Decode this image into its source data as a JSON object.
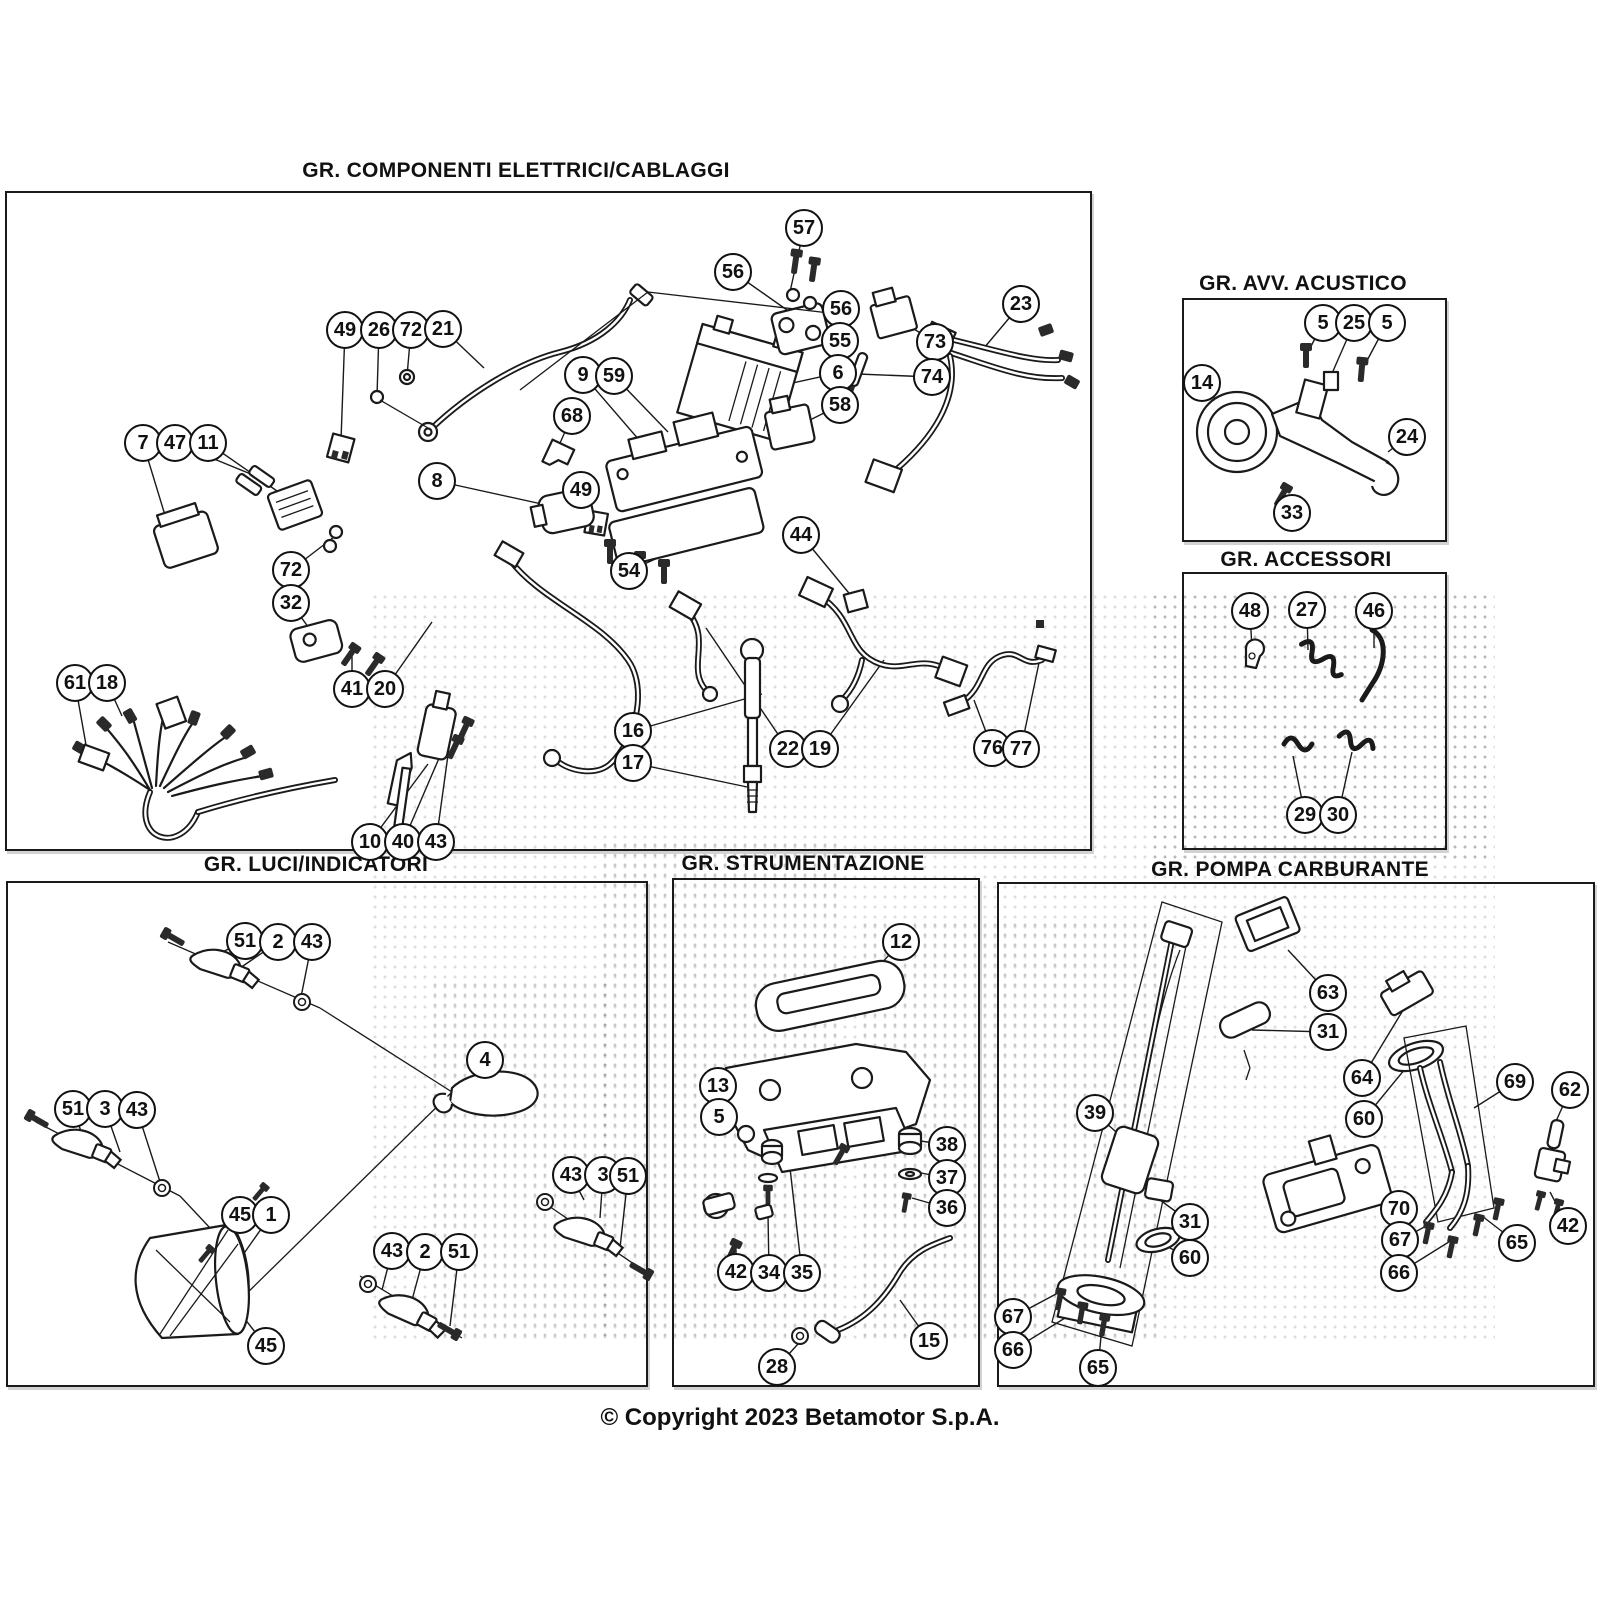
{
  "page": {
    "copyright": "© Copyright 2023 Betamotor S.p.A.",
    "background": "#ffffff",
    "line_color": "#1a1a1a",
    "canvas": {
      "w": 1600,
      "h": 1600
    }
  },
  "sections": [
    {
      "id": "elettrici",
      "title": "GR. COMPONENTI ELETTRICI/CABLAGGI",
      "title_pos": {
        "x": 516,
        "y": 172
      },
      "box": {
        "x": 5,
        "y": 191,
        "w": 1087,
        "h": 660
      },
      "callouts": [
        {
          "n": "57",
          "x": 804,
          "y": 228,
          "t": [
            790,
            292
          ]
        },
        {
          "n": "56",
          "x": 733,
          "y": 272,
          "t": [
            787,
            310
          ]
        },
        {
          "n": "56",
          "x": 841,
          "y": 309,
          "t": [
            806,
            324
          ]
        },
        {
          "n": "55",
          "x": 840,
          "y": 341,
          "t": [
            800,
            340
          ]
        },
        {
          "n": "73",
          "x": 935,
          "y": 342,
          "t": [
            896,
            318
          ]
        },
        {
          "n": "6",
          "x": 838,
          "y": 373,
          "t": [
            788,
            384
          ]
        },
        {
          "n": "74",
          "x": 932,
          "y": 377,
          "t": [
            858,
            374
          ]
        },
        {
          "n": "58",
          "x": 840,
          "y": 405,
          "t": [
            802,
            424
          ]
        },
        {
          "n": "23",
          "x": 1021,
          "y": 304,
          "t": [
            984,
            348
          ]
        },
        {
          "n": "49",
          "x": 345,
          "y": 330,
          "t": [
            341,
            440
          ]
        },
        {
          "n": "26",
          "x": 379,
          "y": 330,
          "t": [
            377,
            396
          ]
        },
        {
          "n": "72",
          "x": 411,
          "y": 330,
          "t": [
            407,
            376
          ]
        },
        {
          "n": "21",
          "x": 443,
          "y": 329,
          "t": [
            484,
            368
          ]
        },
        {
          "n": "9",
          "x": 583,
          "y": 375,
          "t": [
            646,
            448
          ]
        },
        {
          "n": "59",
          "x": 614,
          "y": 376,
          "t": [
            668,
            432
          ]
        },
        {
          "n": "68",
          "x": 572,
          "y": 416,
          "t": [
            556,
            452
          ]
        },
        {
          "n": "7",
          "x": 143,
          "y": 443,
          "t": [
            168,
            525
          ]
        },
        {
          "n": "47",
          "x": 175,
          "y": 443,
          "t": [
            258,
            477
          ]
        },
        {
          "n": "11",
          "x": 208,
          "y": 443,
          "t": [
            290,
            500
          ]
        },
        {
          "n": "8",
          "x": 437,
          "y": 481,
          "t": [
            560,
            508
          ]
        },
        {
          "n": "49",
          "x": 581,
          "y": 490,
          "t": [
            594,
            522
          ]
        },
        {
          "n": "44",
          "x": 801,
          "y": 535,
          "t": [
            853,
            598
          ]
        },
        {
          "n": "54",
          "x": 629,
          "y": 571,
          "t": [
            662,
            556
          ]
        },
        {
          "n": "72",
          "x": 291,
          "y": 570,
          "t": [
            334,
            537
          ]
        },
        {
          "n": "32",
          "x": 291,
          "y": 603,
          "t": [
            316,
            638
          ]
        },
        {
          "n": "41",
          "x": 352,
          "y": 689,
          "t": [
            352,
            648
          ]
        },
        {
          "n": "20",
          "x": 385,
          "y": 689,
          "t": [
            432,
            622
          ]
        },
        {
          "n": "61",
          "x": 75,
          "y": 683,
          "t": [
            88,
            756
          ]
        },
        {
          "n": "18",
          "x": 107,
          "y": 683,
          "t": [
            122,
            716
          ]
        },
        {
          "n": "16",
          "x": 633,
          "y": 731,
          "t": [
            762,
            694
          ]
        },
        {
          "n": "17",
          "x": 633,
          "y": 763,
          "t": [
            752,
            788
          ]
        },
        {
          "n": "22",
          "x": 788,
          "y": 749,
          "t": [
            706,
            628
          ]
        },
        {
          "n": "19",
          "x": 820,
          "y": 749,
          "t": [
            884,
            660
          ]
        },
        {
          "n": "76",
          "x": 992,
          "y": 748,
          "t": [
            974,
            700
          ]
        },
        {
          "n": "77",
          "x": 1021,
          "y": 749,
          "t": [
            1040,
            658
          ]
        },
        {
          "n": "10",
          "x": 370,
          "y": 842,
          "t": [
            428,
            764
          ]
        },
        {
          "n": "40",
          "x": 403,
          "y": 842,
          "t": [
            446,
            742
          ]
        },
        {
          "n": "43",
          "x": 436,
          "y": 842,
          "t": [
            452,
            726
          ]
        }
      ]
    },
    {
      "id": "acustico",
      "title": "GR. AVV. ACUSTICO",
      "title_pos": {
        "x": 1303,
        "y": 285
      },
      "box": {
        "x": 1182,
        "y": 298,
        "w": 265,
        "h": 244
      },
      "callouts": [
        {
          "n": "5",
          "x": 1323,
          "y": 323,
          "t": [
            1307,
            354
          ]
        },
        {
          "n": "25",
          "x": 1354,
          "y": 323,
          "t": [
            1330,
            378
          ]
        },
        {
          "n": "5",
          "x": 1387,
          "y": 323,
          "t": [
            1362,
            370
          ]
        },
        {
          "n": "14",
          "x": 1202,
          "y": 383,
          "t": [
            1224,
            410
          ]
        },
        {
          "n": "24",
          "x": 1407,
          "y": 437,
          "t": [
            1388,
            452
          ]
        },
        {
          "n": "33",
          "x": 1292,
          "y": 513,
          "t": [
            1283,
            494
          ]
        }
      ]
    },
    {
      "id": "accessori",
      "title": "GR. ACCESSORI",
      "title_pos": {
        "x": 1306,
        "y": 561
      },
      "box": {
        "x": 1182,
        "y": 572,
        "w": 265,
        "h": 278
      },
      "callouts": [
        {
          "n": "48",
          "x": 1250,
          "y": 611,
          "t": [
            1252,
            650
          ]
        },
        {
          "n": "27",
          "x": 1307,
          "y": 610,
          "t": [
            1308,
            650
          ]
        },
        {
          "n": "46",
          "x": 1374,
          "y": 611,
          "t": [
            1374,
            648
          ]
        },
        {
          "n": "29",
          "x": 1305,
          "y": 815,
          "t": [
            1293,
            756
          ]
        },
        {
          "n": "30",
          "x": 1338,
          "y": 815,
          "t": [
            1352,
            752
          ]
        }
      ]
    },
    {
      "id": "luci",
      "title": "GR. LUCI/INDICATORI",
      "title_pos": {
        "x": 316,
        "y": 866
      },
      "box": {
        "x": 6,
        "y": 881,
        "w": 642,
        "h": 506
      },
      "callouts": [
        {
          "n": "51",
          "x": 245,
          "y": 941,
          "t": [
            212,
            957
          ]
        },
        {
          "n": "2",
          "x": 278,
          "y": 942,
          "t": [
            240,
            968
          ]
        },
        {
          "n": "43",
          "x": 312,
          "y": 942,
          "t": [
            300,
            1002
          ]
        },
        {
          "n": "4",
          "x": 485,
          "y": 1060,
          "t": [
            502,
            1084
          ]
        },
        {
          "n": "51",
          "x": 73,
          "y": 1109,
          "t": [
            82,
            1134
          ]
        },
        {
          "n": "3",
          "x": 105,
          "y": 1109,
          "t": [
            120,
            1152
          ]
        },
        {
          "n": "43",
          "x": 137,
          "y": 1110,
          "t": [
            162,
            1188
          ]
        },
        {
          "n": "45",
          "x": 240,
          "y": 1215,
          "t": [
            210,
            1255
          ]
        },
        {
          "n": "1",
          "x": 271,
          "y": 1215,
          "t": [
            228,
            1276
          ]
        },
        {
          "n": "43",
          "x": 571,
          "y": 1175,
          "t": [
            584,
            1200
          ]
        },
        {
          "n": "3",
          "x": 603,
          "y": 1175,
          "t": [
            600,
            1218
          ]
        },
        {
          "n": "51",
          "x": 628,
          "y": 1176,
          "t": [
            620,
            1248
          ]
        },
        {
          "n": "45",
          "x": 266,
          "y": 1346,
          "t": [
            230,
            1300
          ]
        },
        {
          "n": "43",
          "x": 392,
          "y": 1251,
          "t": [
            382,
            1290
          ]
        },
        {
          "n": "2",
          "x": 425,
          "y": 1252,
          "t": [
            412,
            1300
          ]
        },
        {
          "n": "51",
          "x": 459,
          "y": 1252,
          "t": [
            450,
            1326
          ]
        }
      ]
    },
    {
      "id": "strumentazione",
      "title": "GR. STRUMENTAZIONE",
      "title_pos": {
        "x": 803,
        "y": 865
      },
      "box": {
        "x": 672,
        "y": 878,
        "w": 308,
        "h": 509
      },
      "callouts": [
        {
          "n": "12",
          "x": 901,
          "y": 942,
          "t": [
            868,
            978
          ]
        },
        {
          "n": "13",
          "x": 718,
          "y": 1086,
          "t": [
            762,
            1075
          ]
        },
        {
          "n": "5",
          "x": 719,
          "y": 1117,
          "t": [
            744,
            1132
          ]
        },
        {
          "n": "38",
          "x": 947,
          "y": 1145,
          "t": [
            914,
            1140
          ]
        },
        {
          "n": "37",
          "x": 947,
          "y": 1178,
          "t": [
            916,
            1172
          ]
        },
        {
          "n": "36",
          "x": 947,
          "y": 1208,
          "t": [
            912,
            1198
          ]
        },
        {
          "n": "42",
          "x": 736,
          "y": 1272,
          "t": [
            736,
            1250
          ]
        },
        {
          "n": "34",
          "x": 769,
          "y": 1273,
          "t": [
            768,
            1214
          ]
        },
        {
          "n": "35",
          "x": 802,
          "y": 1273,
          "t": [
            790,
            1168
          ]
        },
        {
          "n": "28",
          "x": 777,
          "y": 1367,
          "t": [
            798,
            1344
          ]
        },
        {
          "n": "15",
          "x": 929,
          "y": 1341,
          "t": [
            900,
            1300
          ]
        }
      ]
    },
    {
      "id": "pompa",
      "title": "GR. POMPA CARBURANTE",
      "title_pos": {
        "x": 1290,
        "y": 871
      },
      "box": {
        "x": 997,
        "y": 882,
        "w": 598,
        "h": 505
      },
      "callouts": [
        {
          "n": "63",
          "x": 1328,
          "y": 993,
          "t": [
            1288,
            950
          ]
        },
        {
          "n": "31",
          "x": 1328,
          "y": 1032,
          "t": [
            1252,
            1030
          ]
        },
        {
          "n": "64",
          "x": 1362,
          "y": 1078,
          "t": [
            1408,
            1002
          ]
        },
        {
          "n": "60",
          "x": 1364,
          "y": 1119,
          "t": [
            1414,
            1058
          ]
        },
        {
          "n": "39",
          "x": 1095,
          "y": 1113,
          "t": [
            1125,
            1140
          ]
        },
        {
          "n": "69",
          "x": 1515,
          "y": 1082,
          "t": [
            1474,
            1108
          ]
        },
        {
          "n": "62",
          "x": 1570,
          "y": 1090,
          "t": [
            1553,
            1128
          ]
        },
        {
          "n": "70",
          "x": 1399,
          "y": 1209,
          "t": [
            1340,
            1192
          ]
        },
        {
          "n": "42",
          "x": 1568,
          "y": 1226,
          "t": [
            1550,
            1192
          ]
        },
        {
          "n": "67",
          "x": 1400,
          "y": 1240,
          "t": [
            1430,
            1224
          ]
        },
        {
          "n": "65",
          "x": 1517,
          "y": 1243,
          "t": [
            1482,
            1216
          ]
        },
        {
          "n": "66",
          "x": 1399,
          "y": 1273,
          "t": [
            1452,
            1240
          ]
        },
        {
          "n": "31",
          "x": 1190,
          "y": 1222,
          "t": [
            1160,
            1200
          ]
        },
        {
          "n": "60",
          "x": 1190,
          "y": 1258,
          "t": [
            1162,
            1244
          ]
        },
        {
          "n": "67",
          "x": 1013,
          "y": 1317,
          "t": [
            1056,
            1294
          ]
        },
        {
          "n": "66",
          "x": 1013,
          "y": 1350,
          "t": [
            1078,
            1310
          ]
        },
        {
          "n": "65",
          "x": 1098,
          "y": 1368,
          "t": [
            1102,
            1326
          ]
        }
      ]
    }
  ]
}
